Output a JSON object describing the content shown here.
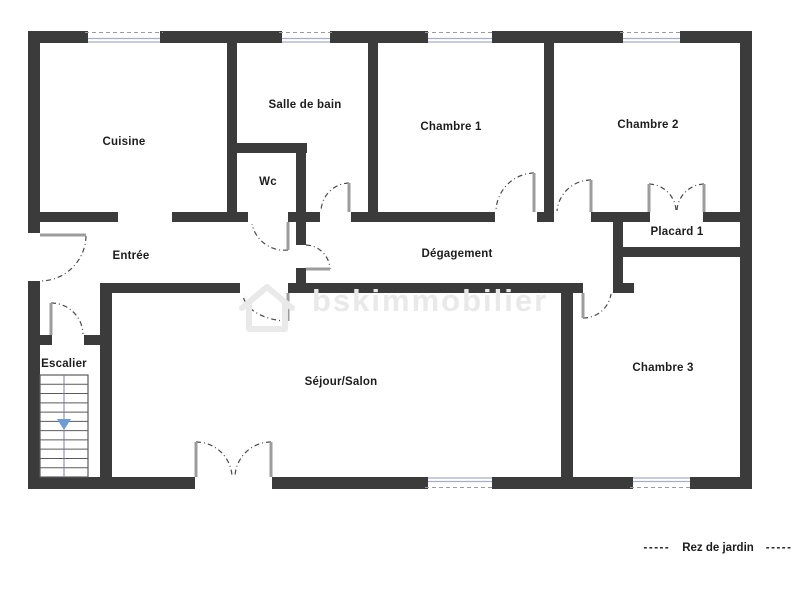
{
  "canvas": {
    "width": 806,
    "height": 597
  },
  "colors": {
    "bg": "#ffffff",
    "wall": "#3b3b3b",
    "leaf": "#9c9c9c",
    "arc": "#4a4a4a",
    "window_line": "#a9aec2",
    "window_dash": "#9b9b9b",
    "stair_line": "#5a5a5a",
    "stair_center": "#76819a",
    "arrow": "#6d9bd3",
    "label": "#1d1d1d",
    "watermark": "#e9e9e9"
  },
  "room_labels": [
    {
      "key": "cuisine",
      "text": "Cuisine",
      "x": 124,
      "y": 142
    },
    {
      "key": "salle-de-bain",
      "text": "Salle de bain",
      "x": 305,
      "y": 105
    },
    {
      "key": "chambre-1",
      "text": "Chambre 1",
      "x": 451,
      "y": 127
    },
    {
      "key": "chambre-2",
      "text": "Chambre 2",
      "x": 648,
      "y": 125
    },
    {
      "key": "wc",
      "text": "Wc",
      "x": 268,
      "y": 182
    },
    {
      "key": "entree",
      "text": "Entrée",
      "x": 131,
      "y": 256
    },
    {
      "key": "degagement",
      "text": "Dégagement",
      "x": 457,
      "y": 254
    },
    {
      "key": "placard-1",
      "text": "Placard 1",
      "x": 677,
      "y": 232
    },
    {
      "key": "escalier",
      "text": "Escalier",
      "x": 64,
      "y": 364
    },
    {
      "key": "sejour-salon",
      "text": "Séjour/Salon",
      "x": 341,
      "y": 382
    },
    {
      "key": "chambre-3",
      "text": "Chambre 3",
      "x": 663,
      "y": 368
    }
  ],
  "caption": {
    "dash_left": "-----",
    "text": "Rez de jardin",
    "dash_right": "-----",
    "x": 718,
    "y": 548
  },
  "watermark": {
    "text": "bskimmobilier",
    "x": 312,
    "y": 311,
    "font_size": 31,
    "letter_spacing": 2,
    "house": {
      "x": 242,
      "y": 287,
      "w": 50,
      "h": 42
    }
  },
  "walls": [
    [
      28,
      31,
      724,
      12
    ],
    [
      28,
      43,
      12,
      190
    ],
    [
      28,
      281,
      12,
      208
    ],
    [
      740,
      43,
      12,
      446
    ],
    [
      28,
      477,
      167,
      12
    ],
    [
      272,
      477,
      480,
      12
    ],
    [
      227,
      43,
      10,
      179
    ],
    [
      237,
      143,
      70,
      10
    ],
    [
      296,
      143,
      10,
      102
    ],
    [
      368,
      43,
      10,
      179
    ],
    [
      544,
      43,
      10,
      179
    ],
    [
      40,
      212,
      78,
      10
    ],
    [
      172,
      212,
      76,
      10
    ],
    [
      288,
      212,
      32,
      10
    ],
    [
      351,
      212,
      144,
      10
    ],
    [
      537,
      212,
      17,
      10
    ],
    [
      591,
      212,
      59,
      10
    ],
    [
      703,
      212,
      37,
      10
    ],
    [
      613,
      222,
      10,
      71
    ],
    [
      613,
      283,
      21,
      10
    ],
    [
      623,
      247,
      117,
      10
    ],
    [
      100,
      283,
      140,
      10
    ],
    [
      288,
      283,
      295,
      10
    ],
    [
      296,
      268,
      10,
      25
    ],
    [
      561,
      293,
      12,
      184
    ],
    [
      100,
      283,
      12,
      194
    ],
    [
      40,
      335,
      12,
      10
    ],
    [
      84,
      335,
      28,
      10
    ]
  ],
  "windows": [
    {
      "x": 88,
      "y": 31,
      "w": 72,
      "h": 12,
      "outer": "top"
    },
    {
      "x": 282,
      "y": 31,
      "w": 48,
      "h": 12,
      "outer": "top"
    },
    {
      "x": 428,
      "y": 31,
      "w": 64,
      "h": 12,
      "outer": "top"
    },
    {
      "x": 623,
      "y": 31,
      "w": 57,
      "h": 12,
      "outer": "top"
    },
    {
      "x": 428,
      "y": 477,
      "w": 64,
      "h": 12,
      "outer": "bottom"
    },
    {
      "x": 633,
      "y": 477,
      "w": 57,
      "h": 12,
      "outer": "bottom"
    }
  ],
  "doors": [
    {
      "name": "entrance-door",
      "leaf": [
        [
          40,
          235
        ],
        [
          86,
          235
        ]
      ],
      "arc": {
        "from": [
          86,
          236
        ],
        "to": [
          41,
          281
        ],
        "r": 46,
        "sweep": 1
      }
    },
    {
      "name": "stairs-door",
      "leaf": [
        [
          51,
          303
        ],
        [
          51,
          335
        ]
      ],
      "arc": {
        "from": [
          51,
          303
        ],
        "to": [
          83,
          334
        ],
        "r": 32,
        "sweep": 1
      }
    },
    {
      "name": "wc-door",
      "leaf": [
        [
          288,
          222
        ],
        [
          288,
          250
        ]
      ],
      "arc": {
        "from": [
          288,
          250
        ],
        "to": [
          252,
          224
        ],
        "r": 33,
        "sweep": 1
      }
    },
    {
      "name": "bathroom-door",
      "leaf": [
        [
          349,
          183
        ],
        [
          349,
          212
        ]
      ],
      "arc": {
        "from": [
          349,
          183
        ],
        "to": [
          321,
          211
        ],
        "r": 29,
        "sweep": 0
      }
    },
    {
      "name": "bedroom1-door",
      "leaf": [
        [
          534,
          173
        ],
        [
          534,
          212
        ]
      ],
      "arc": {
        "from": [
          534,
          173
        ],
        "to": [
          496,
          211
        ],
        "r": 39,
        "sweep": 0
      }
    },
    {
      "name": "bedroom2-door",
      "leaf": [
        [
          591,
          180
        ],
        [
          591,
          212
        ]
      ],
      "arc": {
        "from": [
          591,
          180
        ],
        "to": [
          557,
          211
        ],
        "r": 34,
        "sweep": 0
      }
    },
    {
      "name": "closet-door-left",
      "leaf": [
        [
          649,
          184
        ],
        [
          649,
          212
        ]
      ],
      "arc": {
        "from": [
          649,
          184
        ],
        "to": [
          676,
          210
        ],
        "r": 28,
        "sweep": 1
      }
    },
    {
      "name": "closet-door-right",
      "leaf": [
        [
          704,
          184
        ],
        [
          704,
          212
        ]
      ],
      "arc": {
        "from": [
          704,
          184
        ],
        "to": [
          677,
          210
        ],
        "r": 28,
        "sweep": 0
      }
    },
    {
      "name": "hallway-door",
      "leaf": [
        [
          306,
          269
        ],
        [
          330,
          269
        ]
      ],
      "arc": {
        "from": [
          306,
          245
        ],
        "to": [
          330,
          269
        ],
        "r": 25,
        "sweep": 1
      }
    },
    {
      "name": "living-room-door",
      "leaf": [
        [
          288,
          293
        ],
        [
          288,
          321
        ]
      ],
      "arc": {
        "from": [
          288,
          321
        ],
        "to": [
          243,
          295
        ],
        "rx": 46,
        "ry": 28,
        "sweep": 1
      }
    },
    {
      "name": "bedroom3-door",
      "leaf": [
        [
          583,
          293
        ],
        [
          583,
          318
        ]
      ],
      "arc": {
        "from": [
          583,
          318
        ],
        "to": [
          611,
          294
        ],
        "r": 28,
        "sweep": 0
      }
    },
    {
      "name": "garden-door-left",
      "leaf": [
        [
          196,
          442
        ],
        [
          196,
          477
        ]
      ],
      "arc": {
        "from": [
          196,
          442
        ],
        "to": [
          232,
          476
        ],
        "r": 36,
        "sweep": 1
      }
    },
    {
      "name": "garden-door-right",
      "leaf": [
        [
          271,
          442
        ],
        [
          271,
          477
        ]
      ],
      "arc": {
        "from": [
          271,
          442
        ],
        "to": [
          235,
          476
        ],
        "r": 36,
        "sweep": 0
      }
    }
  ],
  "stairs": {
    "x": 40,
    "y": 375,
    "w": 48,
    "h": 102,
    "steps": 11,
    "center_x": 64,
    "arrow": {
      "tip_x": 64,
      "tip_y": 430,
      "half_w": 7,
      "head_h": 11
    }
  }
}
